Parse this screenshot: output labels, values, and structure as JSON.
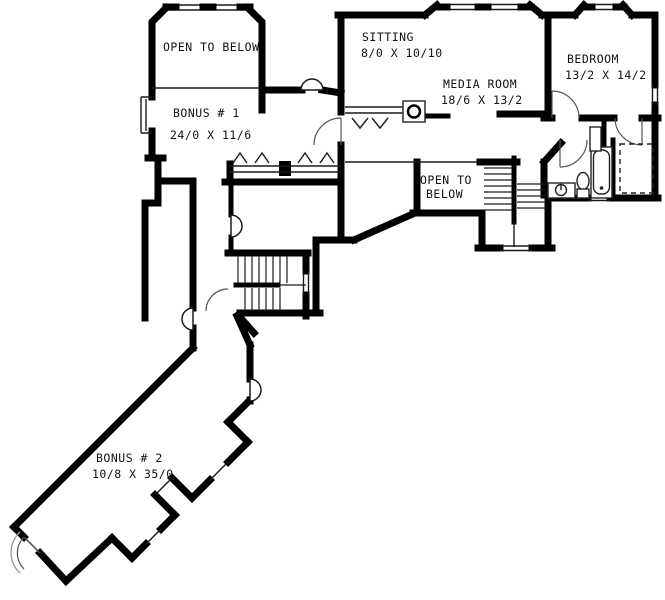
{
  "plan": {
    "title": "Second floor plan",
    "background": "#ffffff",
    "wall_color": "#000000",
    "labels": {
      "tower_open_below": {
        "name": "OPEN TO BELOW"
      },
      "bonus_1": {
        "name": "BONUS # 1",
        "dims": "24/0 X 11/6"
      },
      "sitting": {
        "name": "SITTING",
        "dims": "8/0 X 10/10"
      },
      "media_room": {
        "name": "MEDIA ROOM",
        "dims": "18/6 X 13/2"
      },
      "bedroom": {
        "name": "BEDROOM",
        "dims": "13/2 X 14/2"
      },
      "center_open_below": {
        "line1": "OPEN TO",
        "line2": "BELOW"
      },
      "bonus_2": {
        "name": "BONUS # 2",
        "dims": "10/8 X 35/0"
      }
    }
  }
}
